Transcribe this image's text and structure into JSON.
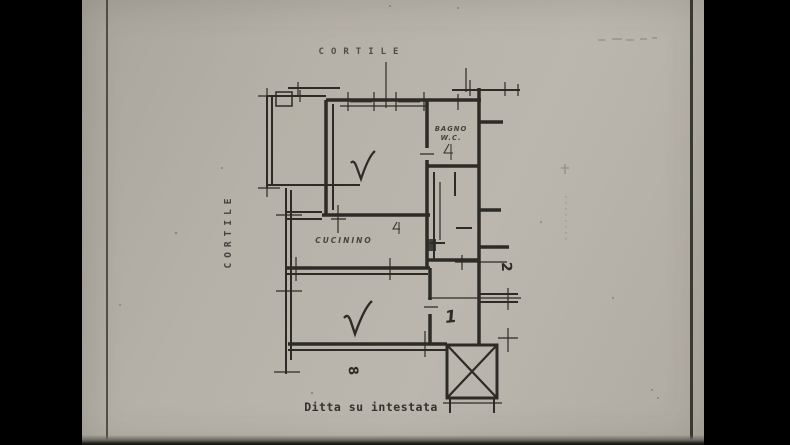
{
  "photo": {
    "colors": {
      "letterbox": "#000000",
      "paper": "#b5b1a8",
      "ink": "#2d2b26",
      "faint_marks": "#6e6a61"
    }
  },
  "floor_plan": {
    "courtyard_top_label": "CORTILE",
    "courtyard_side_label": "CORTILE",
    "kitchen_label": "CUCININO",
    "bathroom_label_line1": "BAGNO",
    "bathroom_label_line2": "W.C.",
    "room_number_hall": "1",
    "room_number_right": "2",
    "room_number_bottom": "8",
    "caption": "Ditta su intestata"
  }
}
